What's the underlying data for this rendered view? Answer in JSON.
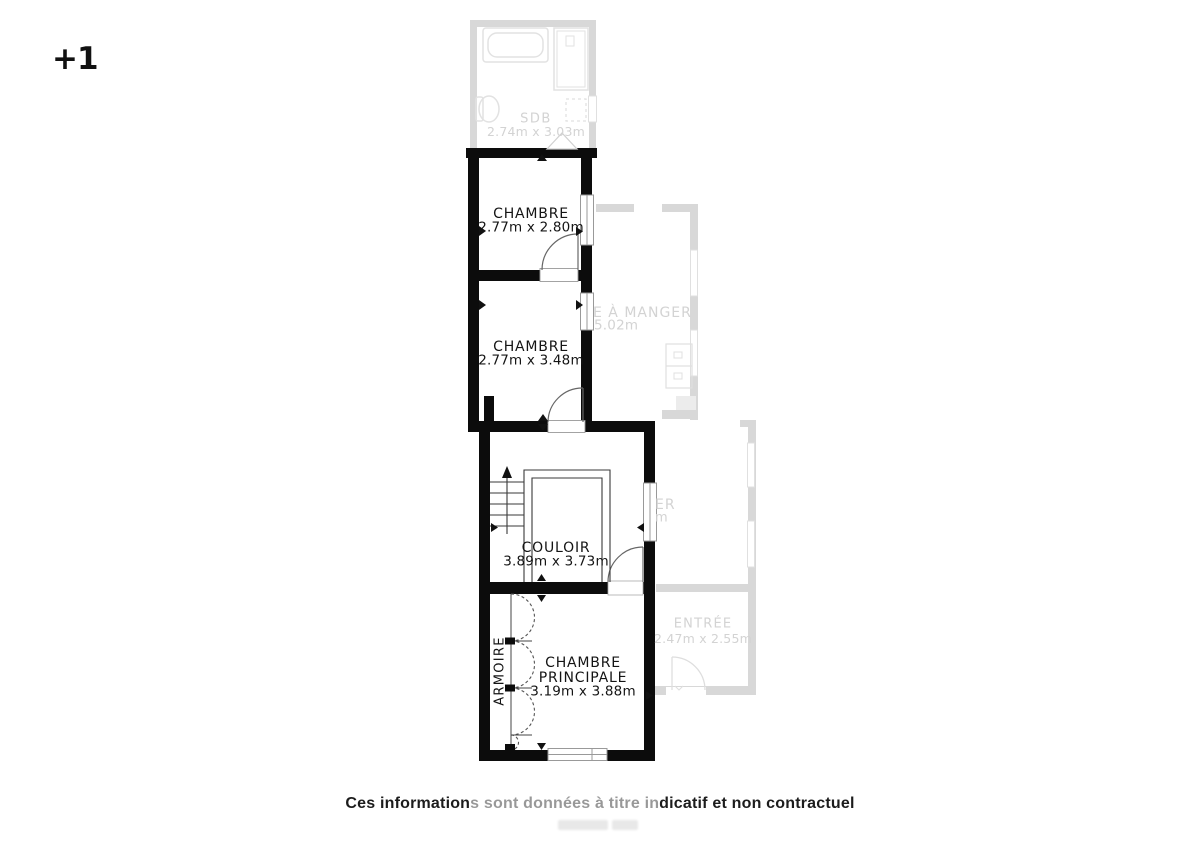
{
  "meta": {
    "floor_label": "+1",
    "disclaimer": "Ces informations sont données à titre indicatif et non contractuel",
    "colors": {
      "wall": "#0c0c0c",
      "faded_wall": "#d8d8d8",
      "label_text": "#141414",
      "faded_label_text": "#d3d3d3",
      "background": "#ffffff"
    }
  },
  "rooms": {
    "sdb": {
      "name": "SDB",
      "dims": "2.74m x 3.03m"
    },
    "chambre_1": {
      "name": "CHAMBRE",
      "dims": "2.77m x 2.80m"
    },
    "chambre_2": {
      "name": "CHAMBRE",
      "dims": "2.77m x 3.48m"
    },
    "salle_a_manger": {
      "name_fragment": "E À MANGER",
      "dims_fragment": "5.02m"
    },
    "couloir": {
      "name": "COULOIR",
      "dims": "3.89m x 3.73m"
    },
    "adjacent_room": {
      "name_fragment": "ER",
      "dims_fragment": "m"
    },
    "entree": {
      "name": "ENTRÉE",
      "dims": "2.47m x 2.55m"
    },
    "chambre_principale": {
      "name_line1": "CHAMBRE",
      "name_line2": "PRINCIPALE",
      "dims": "3.19m x 3.88m"
    },
    "armoire": {
      "name": "ARMOIRE"
    }
  }
}
